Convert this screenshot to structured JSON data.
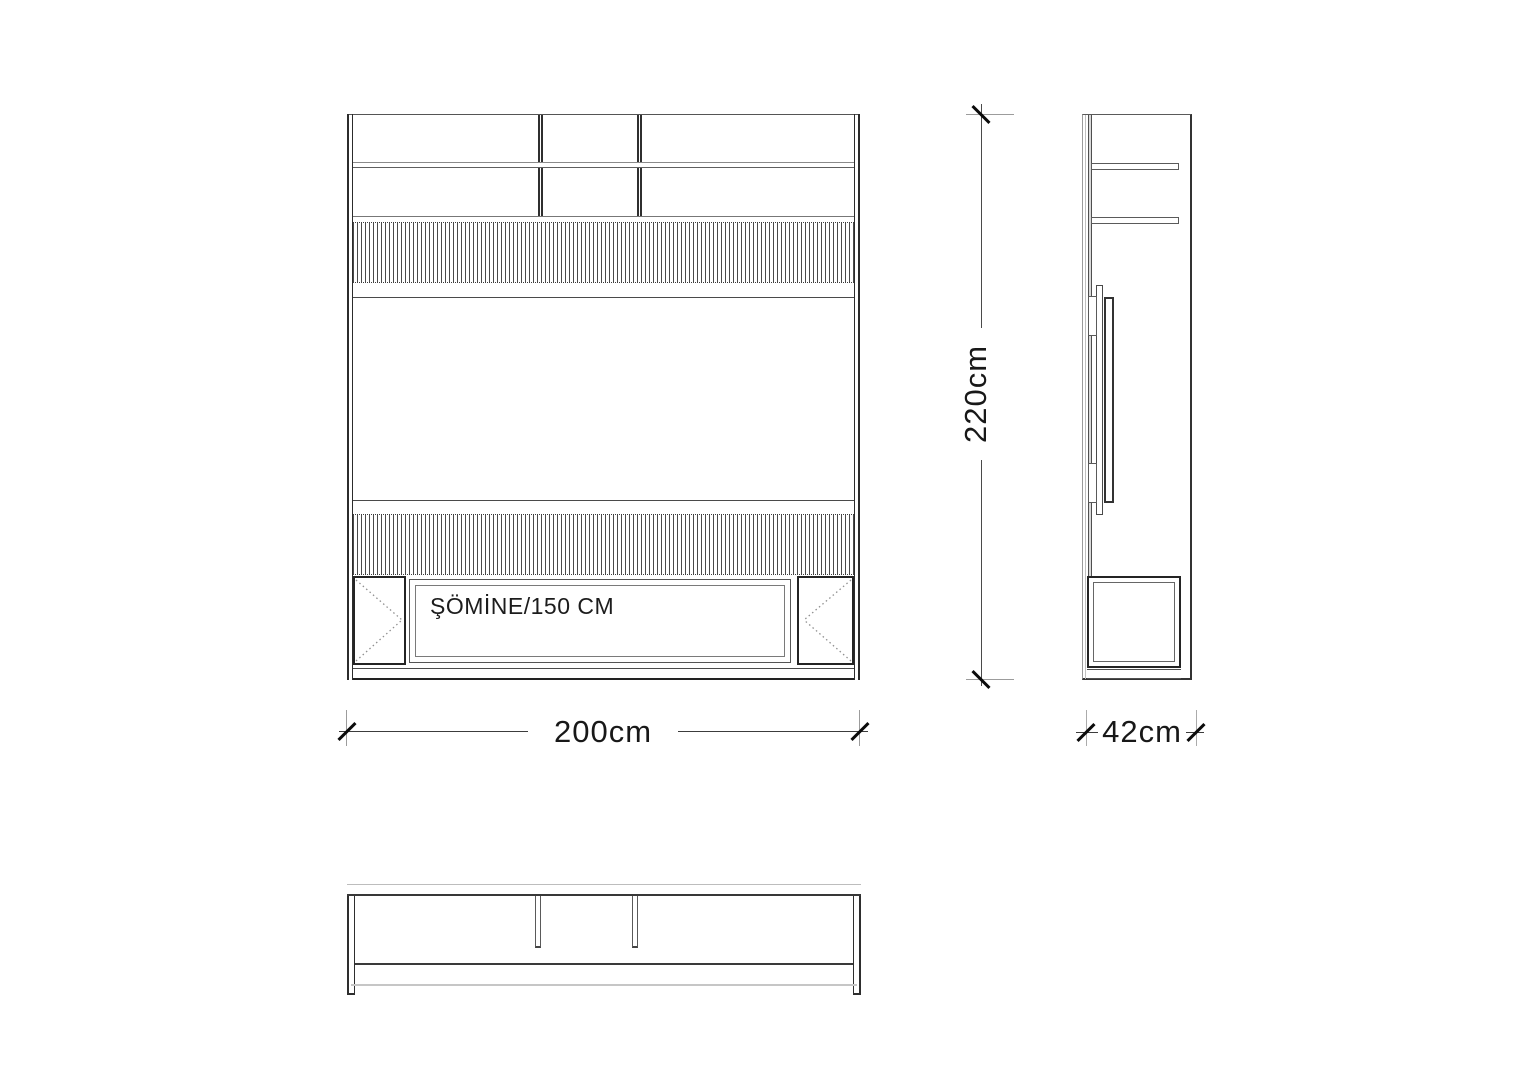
{
  "colors": {
    "line": "#3a3a3a",
    "light_line": "#bdbdbd",
    "text": "#1f1f1f"
  },
  "front_view": {
    "fireplace_label": "ŞÖMİNE/150 CM",
    "width_dimension": "200cm"
  },
  "side_view": {
    "height_dimension": "220cm",
    "depth_dimension": "42cm"
  }
}
